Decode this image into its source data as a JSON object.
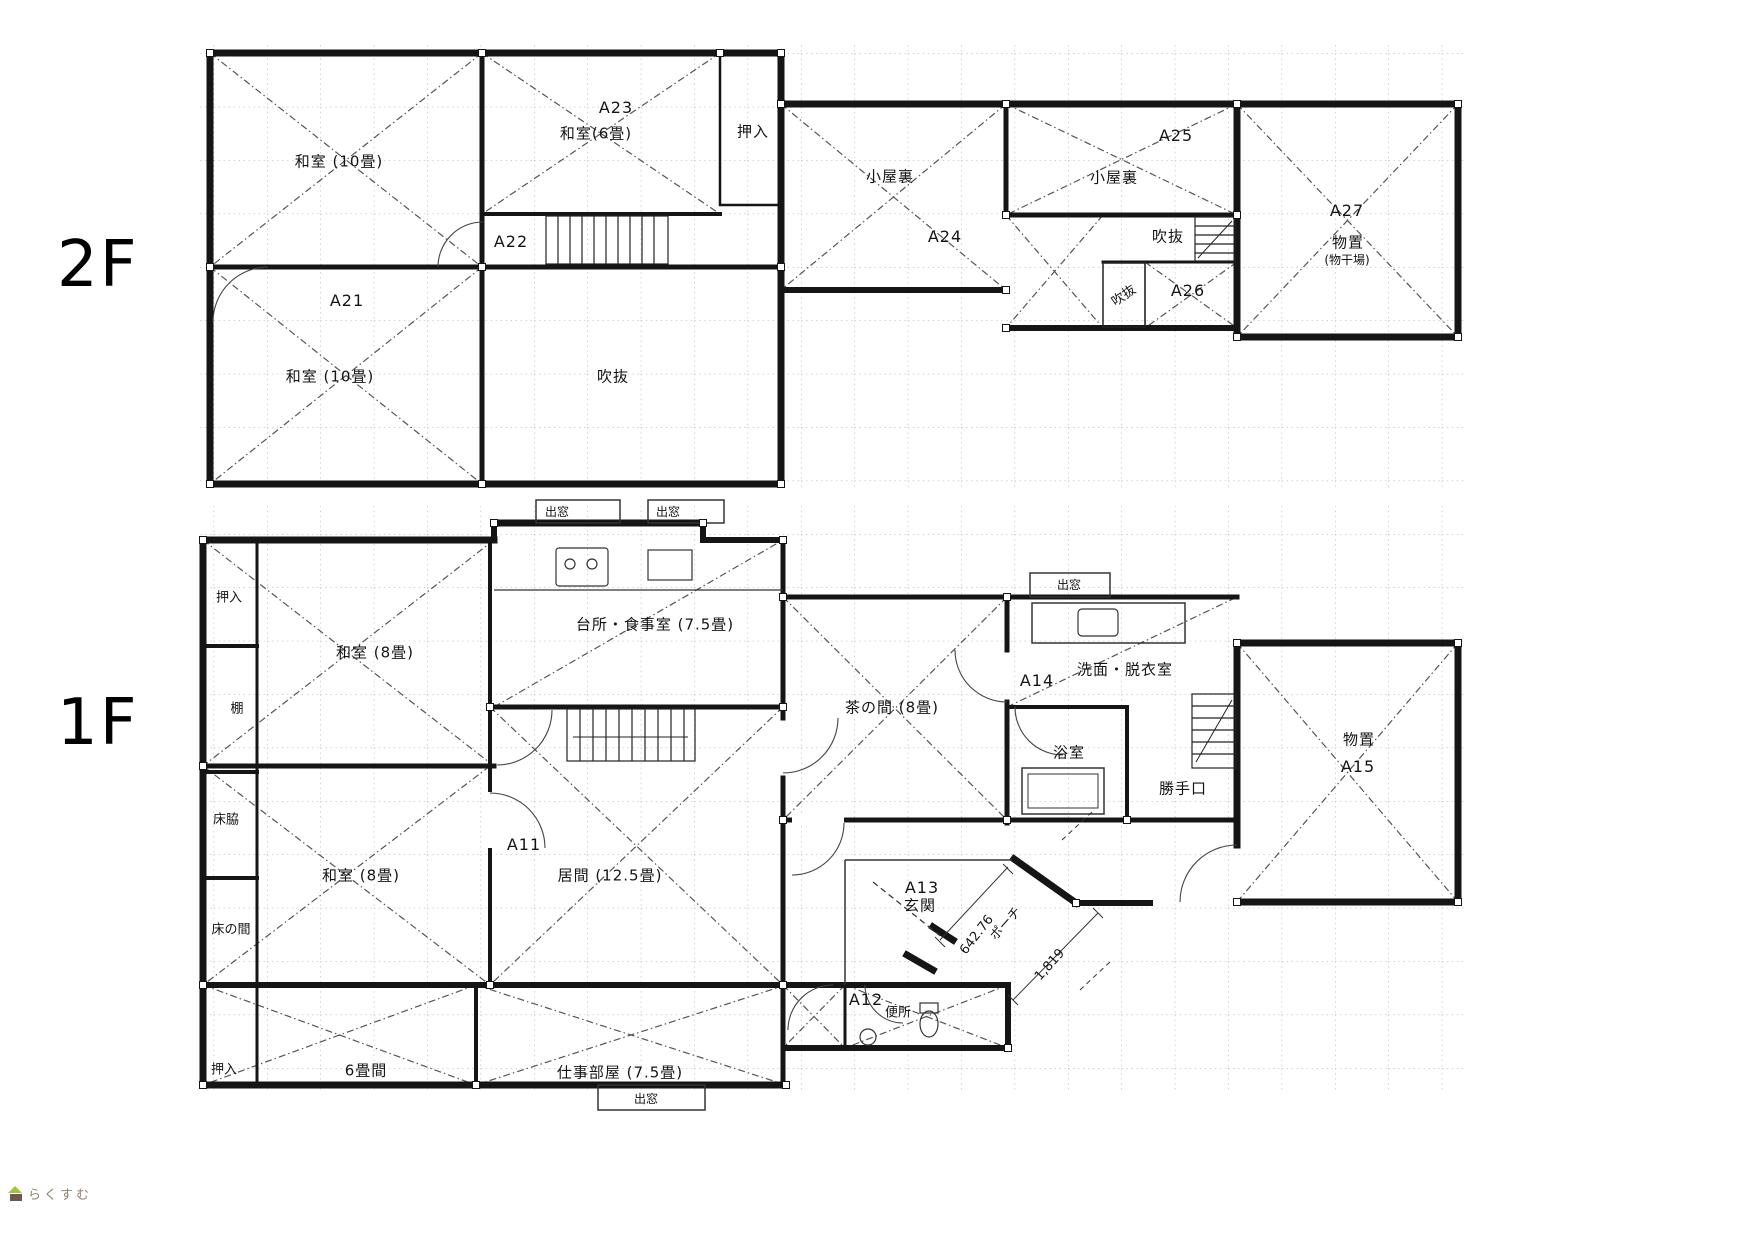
{
  "document": {
    "type": "house-floor-plan-scan",
    "background": "#ffffff"
  },
  "style": {
    "wall_color": "#151515",
    "grid_color": "#a8a8a8",
    "diagonal_color": "#555555",
    "watermark_text_color": "#8d8170",
    "watermark_roof_color": "#a6c23c",
    "watermark_body_color": "#6e5a4b"
  },
  "floors": {
    "f2": {
      "name_label": "2F",
      "labels": [
        {
          "text": "和室 (10畳)"
        },
        {
          "text": "A23"
        },
        {
          "text": "和室(6畳)"
        },
        {
          "text": "押入"
        },
        {
          "text": "A22"
        },
        {
          "text": "A21"
        },
        {
          "text": "和室 (10畳)"
        },
        {
          "text": "吹抜"
        },
        {
          "text": "小屋裏"
        },
        {
          "text": "A24"
        },
        {
          "text": "小屋裏"
        },
        {
          "text": "A25"
        },
        {
          "text": "吹抜"
        },
        {
          "text": "吹抜"
        },
        {
          "text": "A26"
        },
        {
          "text": "A27"
        },
        {
          "text": "物置"
        },
        {
          "text": "(物干場)"
        }
      ]
    },
    "f1": {
      "name_label": "1F",
      "labels": [
        {
          "text": "押入"
        },
        {
          "text": "棚"
        },
        {
          "text": "床脇"
        },
        {
          "text": "床の間"
        },
        {
          "text": "押入"
        },
        {
          "text": "和室 (8畳)"
        },
        {
          "text": "台所・食事室 (7.5畳)"
        },
        {
          "text": "出窓"
        },
        {
          "text": "出窓"
        },
        {
          "text": "出窓"
        },
        {
          "text": "A11"
        },
        {
          "text": "居間 (12.5畳)"
        },
        {
          "text": "和室 (8畳)"
        },
        {
          "text": "6畳間"
        },
        {
          "text": "仕事部屋 (7.5畳)"
        },
        {
          "text": "出窓"
        },
        {
          "text": "茶の間 (8畳)"
        },
        {
          "text": "A14"
        },
        {
          "text": "洗面・脱衣室"
        },
        {
          "text": "浴室"
        },
        {
          "text": "勝手口"
        },
        {
          "text": "物置"
        },
        {
          "text": "A15"
        },
        {
          "text": "A13"
        },
        {
          "text": "玄関"
        },
        {
          "text": "A12"
        },
        {
          "text": "便所"
        },
        {
          "text": "642.76"
        },
        {
          "text": "ポーチ"
        },
        {
          "text": "1,819"
        }
      ]
    }
  },
  "watermark": {
    "text": "らくすむ",
    "icon": "house-icon"
  }
}
